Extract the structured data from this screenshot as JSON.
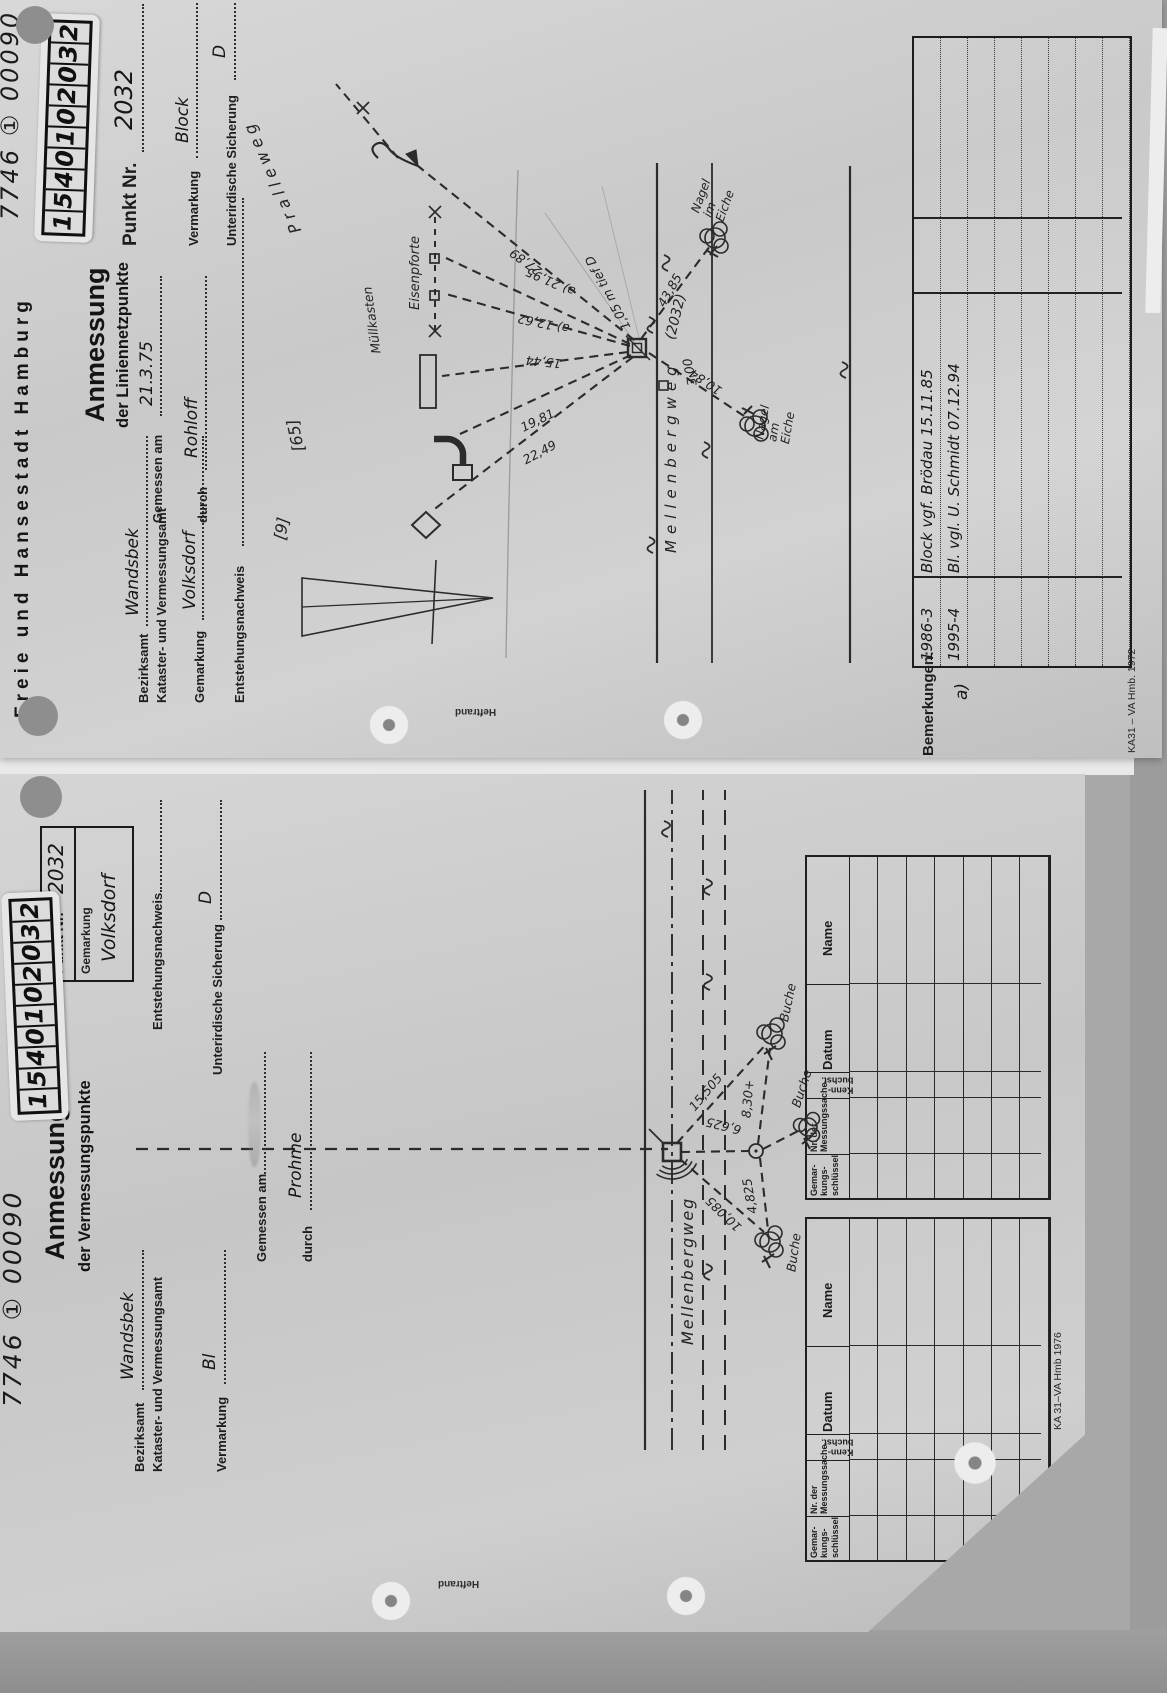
{
  "scan": {
    "heftrand": "Heftrand"
  },
  "doc1": {
    "corner_number": "7746 ① 00090",
    "sticker": [
      "1",
      "5",
      "4",
      "0",
      "1",
      "0",
      "2",
      "0",
      "3",
      "2"
    ],
    "header": "Freie und Hansestadt Hamburg",
    "title": "Anmessung",
    "subtitle": "der Liniennetzpunkte",
    "fields": {
      "punkt_nr_label": "Punkt Nr.",
      "punkt_nr": "2032",
      "bezirksamt_label": "Bezirksamt",
      "bezirksamt": "Wandsbek",
      "amt_label": "Kataster- und Vermessungsamt",
      "gemarkung_label": "Gemarkung",
      "gemarkung": "Volksdorf",
      "entstehung_label": "Entstehungsnachweis",
      "gemessen_label": "Gemessen am",
      "gemessen": "21.3.75",
      "durch_label": "durch",
      "durch": "Rohloff",
      "vermarkung_label": "Vermarkung",
      "vermarkung": "Block",
      "sicherung_label": "Unterirdische Sicherung",
      "sicherung": "D"
    },
    "sketch": {
      "strasse1": "Pralleweg",
      "hausnr9": "[9]",
      "hausnr65": "[65]",
      "eisenpforte": "Eisenpforte",
      "muellkasten": "Müllkasten",
      "strasse2": "Mellenbergweg",
      "punktnr": "(2032)",
      "tiefe": "1,05 m tief D",
      "d300": "3,00",
      "d4385": "43,85",
      "d1084": "10,84",
      "d2789": "27,89",
      "d2195": "a) 21,95",
      "d1262": "a) 12,62",
      "d1544": "15,44",
      "d1981": "19,81",
      "d2249": "22,49",
      "baum1": "Nagel\nim\nEiche",
      "baum2": "Nagel\nam\nEiche"
    },
    "bemerkungen_label": "Bemerkungen:",
    "note_a": "a)",
    "bemerkungen_rows": [
      {
        "nr": "1986-3",
        "text": "Block vgf. Brödau 15.11.85"
      },
      {
        "nr": "1995-4",
        "text": "Bl. vgl. U. Schmidt 07.12.94"
      }
    ],
    "form_code": "KA31 – VA Hmb. 1972"
  },
  "doc2": {
    "corner_number": "7746 ① 00090",
    "sticker": [
      "1",
      "5",
      "4",
      "0",
      "1",
      "0",
      "2",
      "0",
      "3",
      "2"
    ],
    "title": "Anmessung",
    "subtitle": "der Vermessungspunkte",
    "box": {
      "punkt_nr_label": "Punkt Nr.",
      "punkt_nr": "2032",
      "gemarkung_label": "Gemarkung",
      "gemarkung": "Volksdorf"
    },
    "fields": {
      "bezirksamt_label": "Bezirksamt",
      "bezirksamt": "Wandsbek",
      "amt_label": "Kataster- und Vermessungsamt",
      "vermarkung_label": "Vermarkung",
      "vermarkung": "Bl",
      "gemessen_label": "Gemessen am",
      "durch_label": "durch",
      "durch": "Prohme",
      "entstehung_label": "Entstehungsnachweis",
      "sicherung_label": "Unterirdische Sicherung",
      "sicherung": "D"
    },
    "sketch": {
      "strasse": "Mellenbergweg",
      "baum": "Buche",
      "d15505": "15,505",
      "d830": "8,30+",
      "d6625": "6,625",
      "d10085": "10,085",
      "d4825": "4,825"
    },
    "table_headers": [
      "Gemar-\nkungs-\nschlüssel",
      "Nr. der\nMessungssache",
      "Kenn-\nbuchst.",
      "Datum",
      "Name"
    ],
    "form_code": "KA 31–VA Hmb 1976"
  }
}
